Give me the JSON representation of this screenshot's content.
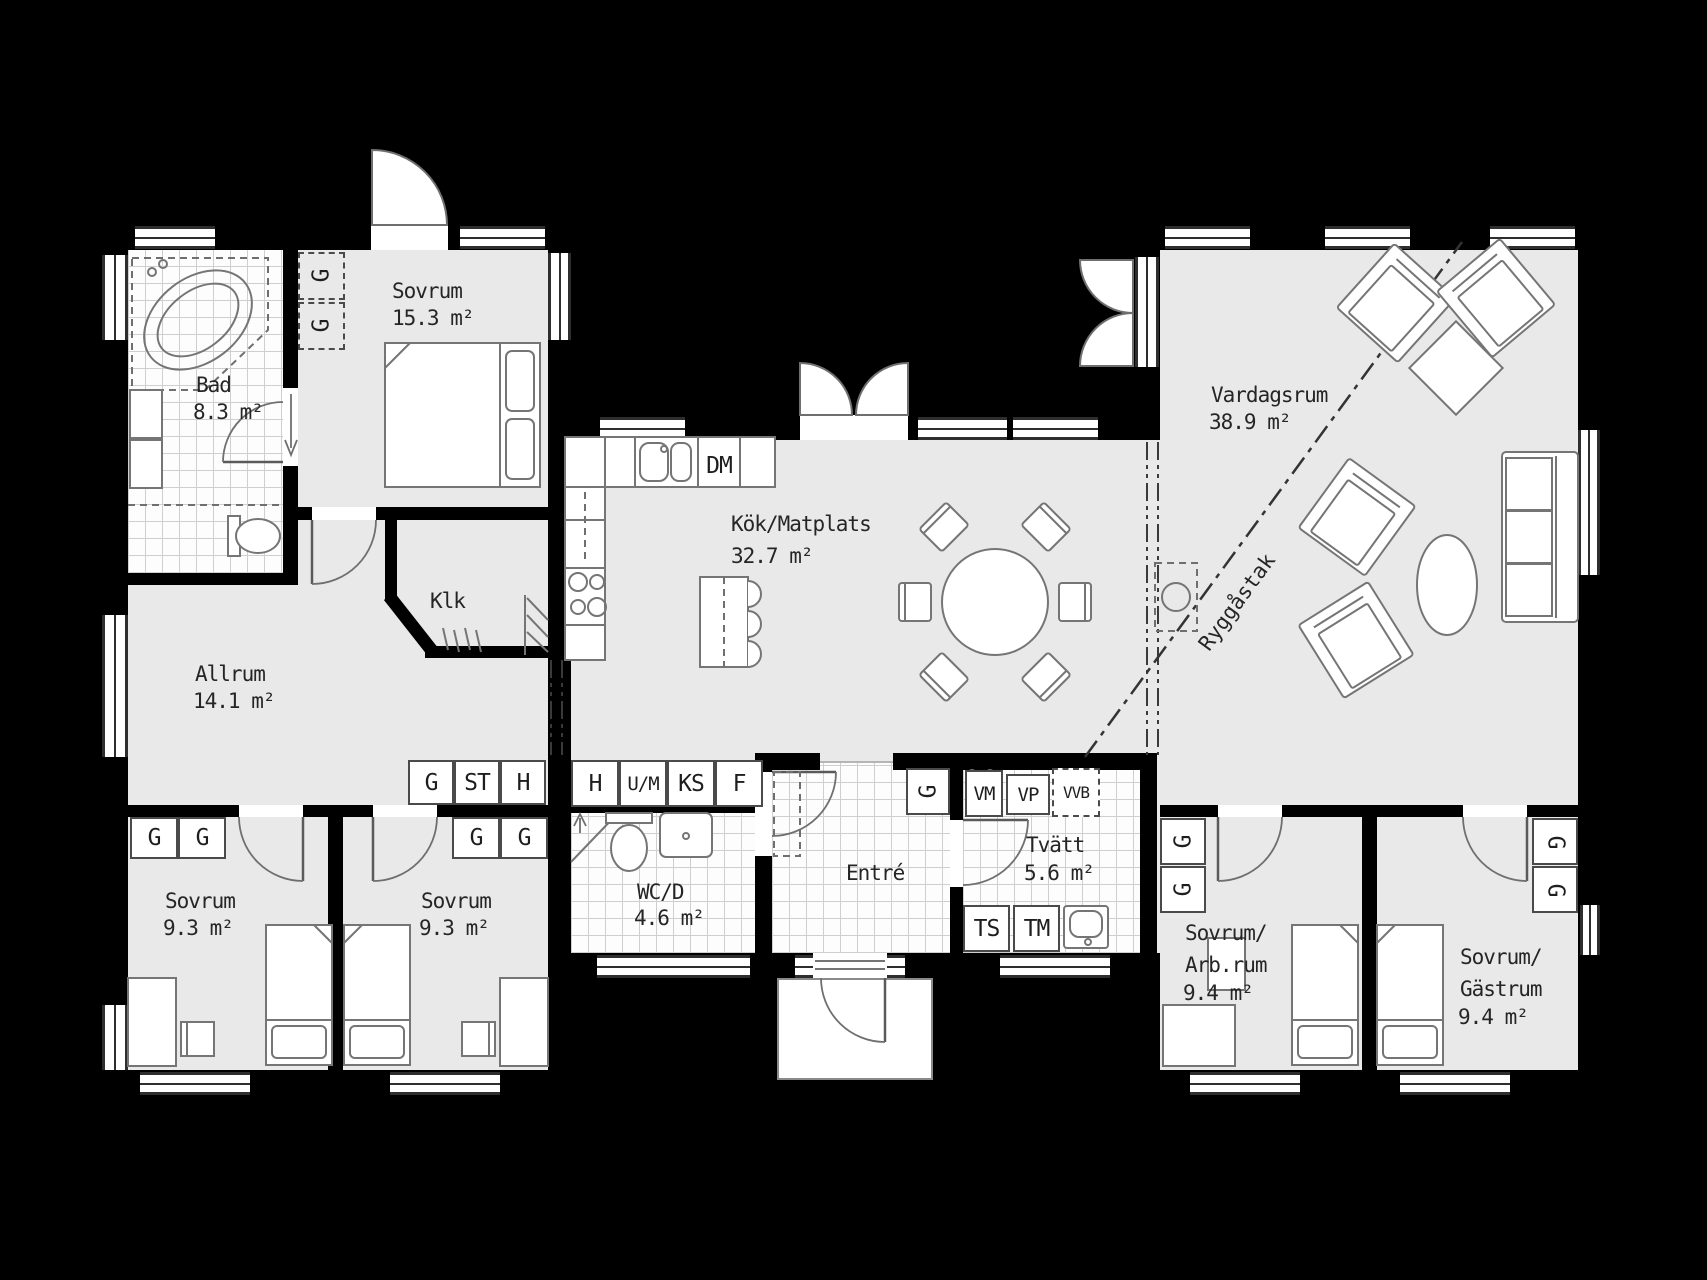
{
  "plan": {
    "title": "Enplansvilla planritning",
    "colors": {
      "background": "#000000",
      "floor": "#e9e9e9",
      "tile": "#fdfdfd",
      "wall": "#000000",
      "furniture_stroke": "#757575",
      "text": "#252525"
    },
    "rooms": {
      "bad": {
        "name": "Bad",
        "area": "8.3 m²"
      },
      "sovrum_stor": {
        "name": "Sovrum",
        "area": "15.3 m²"
      },
      "klk": {
        "name": "Klk"
      },
      "allrum": {
        "name": "Allrum",
        "area": "14.1 m²"
      },
      "sovrum_v": {
        "name": "Sovrum",
        "area": "9.3 m²"
      },
      "sovrum_h": {
        "name": "Sovrum",
        "area": "9.3 m²"
      },
      "wcd": {
        "name": "WC/D",
        "area": "4.6 m²"
      },
      "kok": {
        "name": "Kök/Matplats",
        "area": "32.7 m²"
      },
      "entre": {
        "name": "Entré"
      },
      "tvatt": {
        "name": "Tvätt",
        "area": "5.6 m²"
      },
      "vardagsrum": {
        "name": "Vardagsrum",
        "area": "38.9 m²"
      },
      "arbrum": {
        "line1": "Sovrum/",
        "line2": "Arb.rum",
        "area": "9.4 m²"
      },
      "gastrum": {
        "line1": "Sovrum/",
        "line2": "Gästrum",
        "area": "9.4 m²"
      }
    },
    "annotations": {
      "ridge": "Ryggåstak"
    },
    "fixtures": {
      "dm": "DM",
      "vm": "VM",
      "vp": "VP",
      "vvb": "VVB",
      "ts": "TS",
      "tm": "TM",
      "g": "G",
      "closet_row_allrum": [
        "G",
        "ST",
        "H"
      ],
      "closet_row_kok": [
        "H",
        "U/M",
        "KS",
        "F"
      ]
    }
  }
}
